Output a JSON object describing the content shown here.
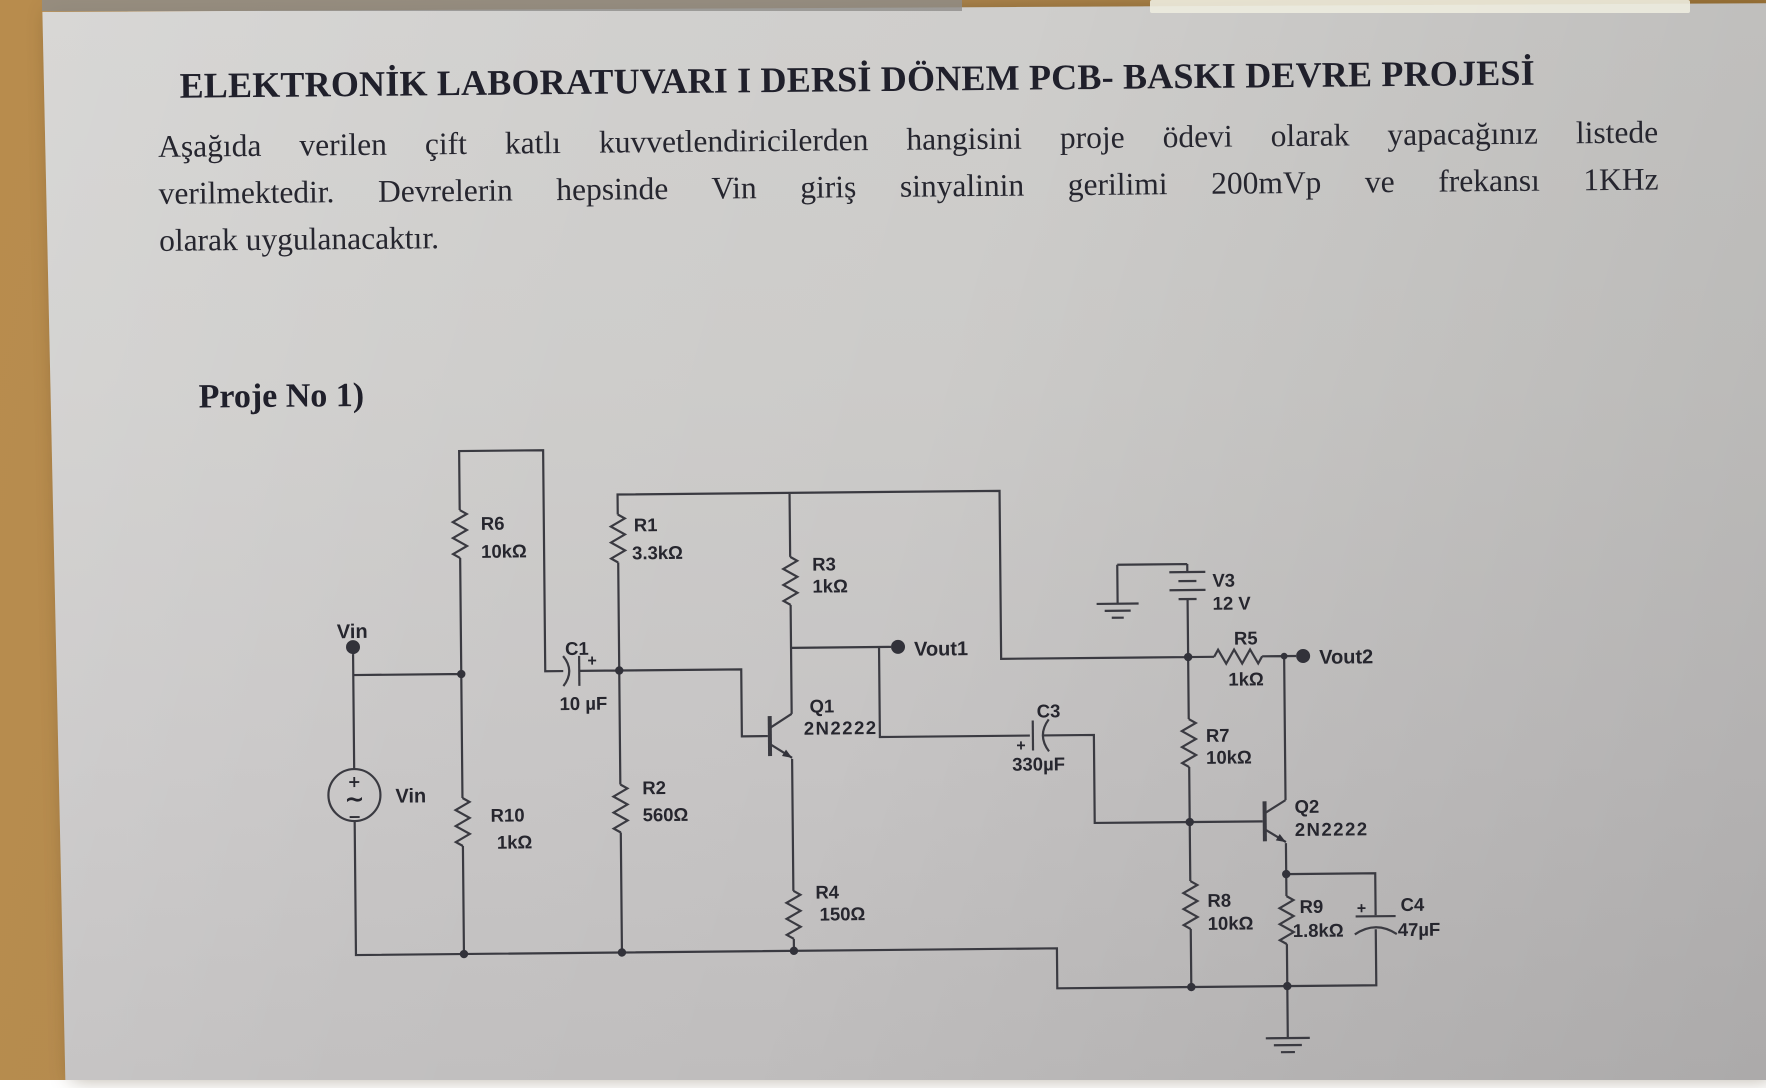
{
  "doc": {
    "title": "ELEKTRONİK LABORATUVARI I DERSİ DÖNEM PCB- BASKI DEVRE PROJESİ",
    "paragraph_lines": {
      "l1": "Aşağıda verilen çift katlı kuvvetlendiricilerden hangisini proje ödevi olarak yapacağınız listede",
      "l2": "verilmektedir. Devrelerin hepsinde Vin giriş sinyalinin gerilimi 200mVp ve frekansı 1KHz",
      "l3": "olarak uygulanacaktır."
    },
    "project_label": "Proje No 1)"
  },
  "palette": {
    "paper": "#cbcac8",
    "desk_wood": "#b28a52",
    "ink": "#26262f",
    "schematic_line": "#3a3a41"
  },
  "schematic": {
    "terminals": {
      "vin": "Vin",
      "vout1": "Vout1",
      "vout2": "Vout2"
    },
    "source": {
      "label": "Vin",
      "plus": "+",
      "sine": "~",
      "minus": "−"
    },
    "components": {
      "r1": {
        "ref": "R1",
        "value": "3.3kΩ"
      },
      "r2": {
        "ref": "R2",
        "value": "560Ω"
      },
      "r3": {
        "ref": "R3",
        "value": "1kΩ"
      },
      "r4": {
        "ref": "R4",
        "value": "150Ω"
      },
      "r5": {
        "ref": "R5",
        "value": "1kΩ"
      },
      "r6": {
        "ref": "R6",
        "value": "10kΩ"
      },
      "r7": {
        "ref": "R7",
        "value": "10kΩ"
      },
      "r8": {
        "ref": "R8",
        "value": "10kΩ"
      },
      "r9": {
        "ref": "R9",
        "value": "1.8kΩ"
      },
      "r10": {
        "ref": "R10",
        "value": "1kΩ"
      },
      "c1": {
        "ref": "C1",
        "value": "10 µF",
        "plus": "+"
      },
      "c3": {
        "ref": "C3",
        "value": "330µF",
        "plus": "+"
      },
      "c4": {
        "ref": "C4",
        "value": "47µF",
        "plus": "+"
      },
      "q1": {
        "ref": "Q1",
        "value": "2N2222"
      },
      "q2": {
        "ref": "Q2",
        "value": "2N2222"
      },
      "v3": {
        "ref": "V3",
        "value": "12 V"
      }
    }
  }
}
